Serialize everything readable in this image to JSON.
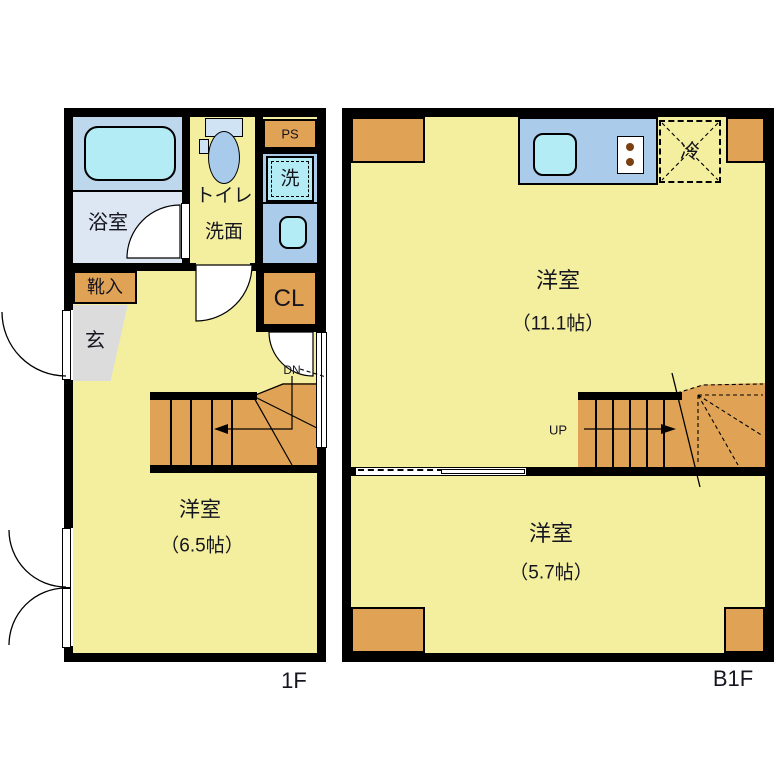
{
  "title": "floorplan",
  "floor_1f": {
    "name": "1F",
    "bathroom": "浴室",
    "toilet": "トイレ",
    "washroom": "洗面",
    "pipe_space": "PS",
    "washer": "洗",
    "shoe_cabinet": "靴入",
    "entrance": "玄",
    "closet": "CL",
    "stairs_down": "DN",
    "room": "洋室",
    "room_size": "（6.5帖）"
  },
  "floor_b1f": {
    "name": "B1F",
    "fridge": "冷",
    "room_upper": "洋室",
    "room_upper_size": "（11.1帖）",
    "stairs_up": "UP",
    "room_lower": "洋室",
    "room_lower_size": "（5.7帖）"
  },
  "colors": {
    "floor": "#F4EF9E",
    "stairs_and_storage": "#E0A356",
    "wall": "#000000",
    "counter_blue": "#AACBE9",
    "bath_upper": "#BDD7EC",
    "bath_lower": "#DCE7F3",
    "fixture_cyan": "#B4ECF5",
    "entrance_gray": "#DCDCDC",
    "toilet_bowl_blue": "#A9CBEB",
    "tank_blue": "#CFE3F4",
    "burner_brown": "#7B3F10"
  }
}
